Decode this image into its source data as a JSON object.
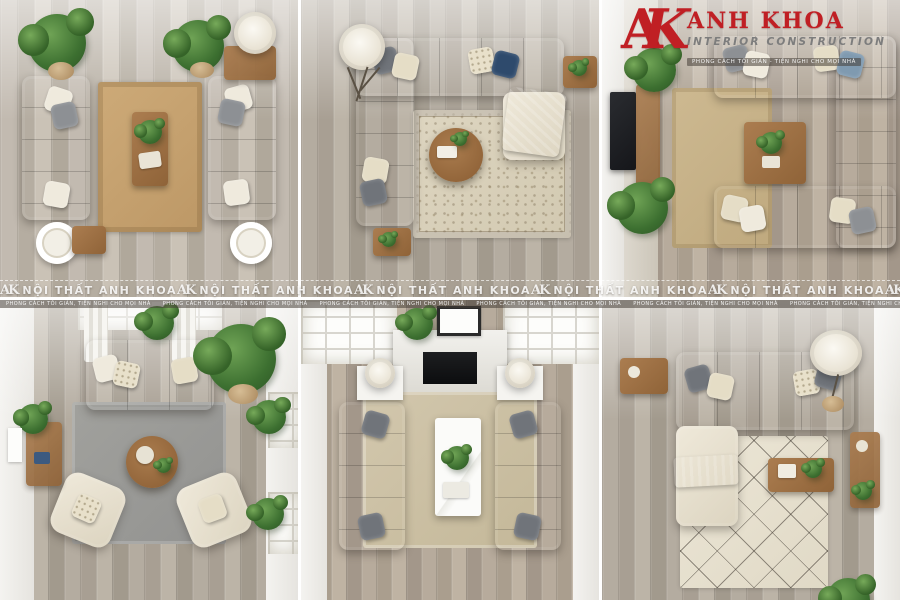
{
  "page": {
    "kind": "interior-design-photo-collage",
    "grid": "2 rows x 3 columns",
    "width_px": 900,
    "height_px": 600
  },
  "branding": {
    "monogram_a": "A",
    "monogram_k": "K",
    "brand_name": "ANH KHOA",
    "brand_subtitle": "INTERIOR CONSTRUCTION",
    "brand_tagline": "PHONG CÁCH TỐI GIẢN - TIỆN NGHI CHO MỌI NHÀ",
    "brand_color": "#c01f24",
    "subtitle_color": "#7d7d7d"
  },
  "watermark": {
    "monogram_a": "A",
    "monogram_k": "K",
    "text": "NỘI THẤT ANH KHOA",
    "repeat_count": 6,
    "color": "rgba(255,255,255,0.85)"
  },
  "caption_strip": {
    "text": "PHONG CÁCH TỐI GIẢN, TIỆN NGHI CHO MỌI NHÀ",
    "repeat_count": 6
  },
  "panels": [
    {
      "id": "panel-1",
      "position": "top-left",
      "description": "Two gray sofas facing each other across a jute rug with wooden coffee table, potted plants and drum lamps",
      "floor": "#c2bab0",
      "sofa_color": "#8a8d92",
      "rug_color": "#c9a472"
    },
    {
      "id": "panel-2",
      "position": "top-center",
      "description": "Cream U-shaped sectional around a round wooden coffee table on an ornate beige rug, tripod floor lamp, navy pillows, gray throw",
      "floor": "#b4aca0",
      "sofa_color": "#e5ddc9",
      "rug_color": "#d8d0ba"
    },
    {
      "id": "panel-3",
      "position": "top-right",
      "description": "Charcoal U-shaped sectional opening toward wall-mounted TV and wooden console, square wooden coffee table, beige rug, plants",
      "floor": "#b7ab9c",
      "sofa_color": "#4b4f56",
      "rug_color": "#cbb78f"
    },
    {
      "id": "panel-4",
      "position": "bottom-left",
      "description": "Navy blue sofa under a bright window facing two cream swivel armchairs over a gray rug with round wooden coffee table",
      "floor": "#b4aca0",
      "sofa_color": "#2f4e76",
      "rug_color": "#9b9b97"
    },
    {
      "id": "panel-5",
      "position": "bottom-center",
      "description": "Symmetric room with fireplace and skylights, two gray sofas facing each other across a white marble coffee table on a beige rug",
      "floor": "#b7ab99",
      "sofa_color": "#8e9093",
      "rug_color": "#cfc4ac"
    },
    {
      "id": "panel-6",
      "position": "bottom-right",
      "description": "Cream L-shaped sectional with gray pillows and throw on a geometric-pattern cream rug, wooden coffee table and wall shelf",
      "floor": "#b2a899",
      "sofa_color": "#e7e0cf",
      "rug_color": "#e8e2d4"
    }
  ]
}
